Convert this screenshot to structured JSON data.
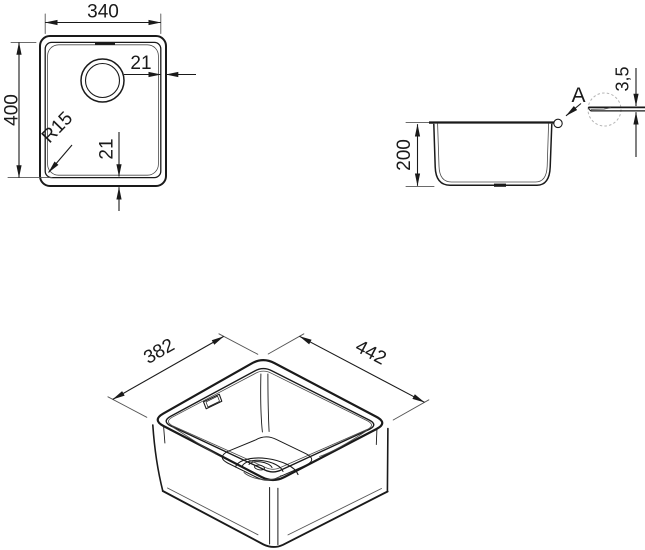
{
  "colors": {
    "line": "#1a1a1a",
    "background": "#ffffff",
    "thin_line": "#555555",
    "detail_circle": "#b5b5b5"
  },
  "views": {
    "top": {
      "inner_width_mm": "340",
      "inner_length_mm": "400",
      "drain_edge_offset_mm": "21",
      "corner_radius": "R15",
      "bottom_edge_offset_mm": "21"
    },
    "side": {
      "bowl_depth_mm": "200",
      "detail_marker": "A",
      "rim_thickness_mm": "3,5"
    },
    "isometric": {
      "outer_width_mm": "382",
      "outer_length_mm": "442"
    }
  }
}
